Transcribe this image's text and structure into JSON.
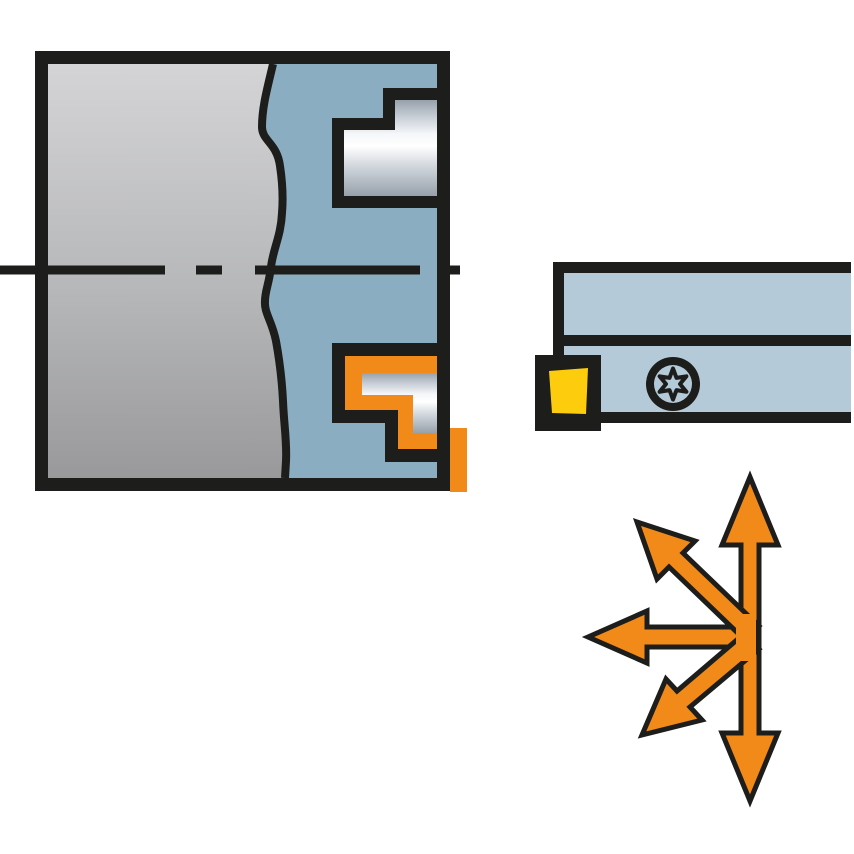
{
  "illustration": {
    "kind": "technical-catalog-drawing",
    "description": "Profiling tool application: workpiece cross-section with tool profile, tool holder with insert and screw, multi-directional feed arrows"
  },
  "colors": {
    "background": "#ffffff",
    "outline": "#1d1d1b",
    "tool_blue": "#8aadc2",
    "holder_blue": "#b5cad8",
    "orange": "#f18a19",
    "yellow": "#fdcc0c"
  },
  "gradients": {
    "workpiece": {
      "top": "#d4d4d6",
      "mid": "#b6b7b9",
      "bottom": "#99999b"
    },
    "metal": {
      "s0": "#97a1ab",
      "s1": "#c9cfd7",
      "s2": "#f4f6f8",
      "s3": "#ffffff",
      "s4": "#cfd5db",
      "s5": "#97a1ab"
    }
  },
  "components": {
    "workpiece_figure": "workpiece cross-section with internal profile",
    "center_line": "dashed center line",
    "tool_profile": "tool body cross-section",
    "upper_pocket": "upper insert pocket",
    "lower_pocket": "active insert pocket (highlighted)",
    "holder_figure": "tool holder side view",
    "insert": "cutting insert",
    "screw": "Torx insert screw",
    "arrows": "multi-directional feed arrows"
  }
}
